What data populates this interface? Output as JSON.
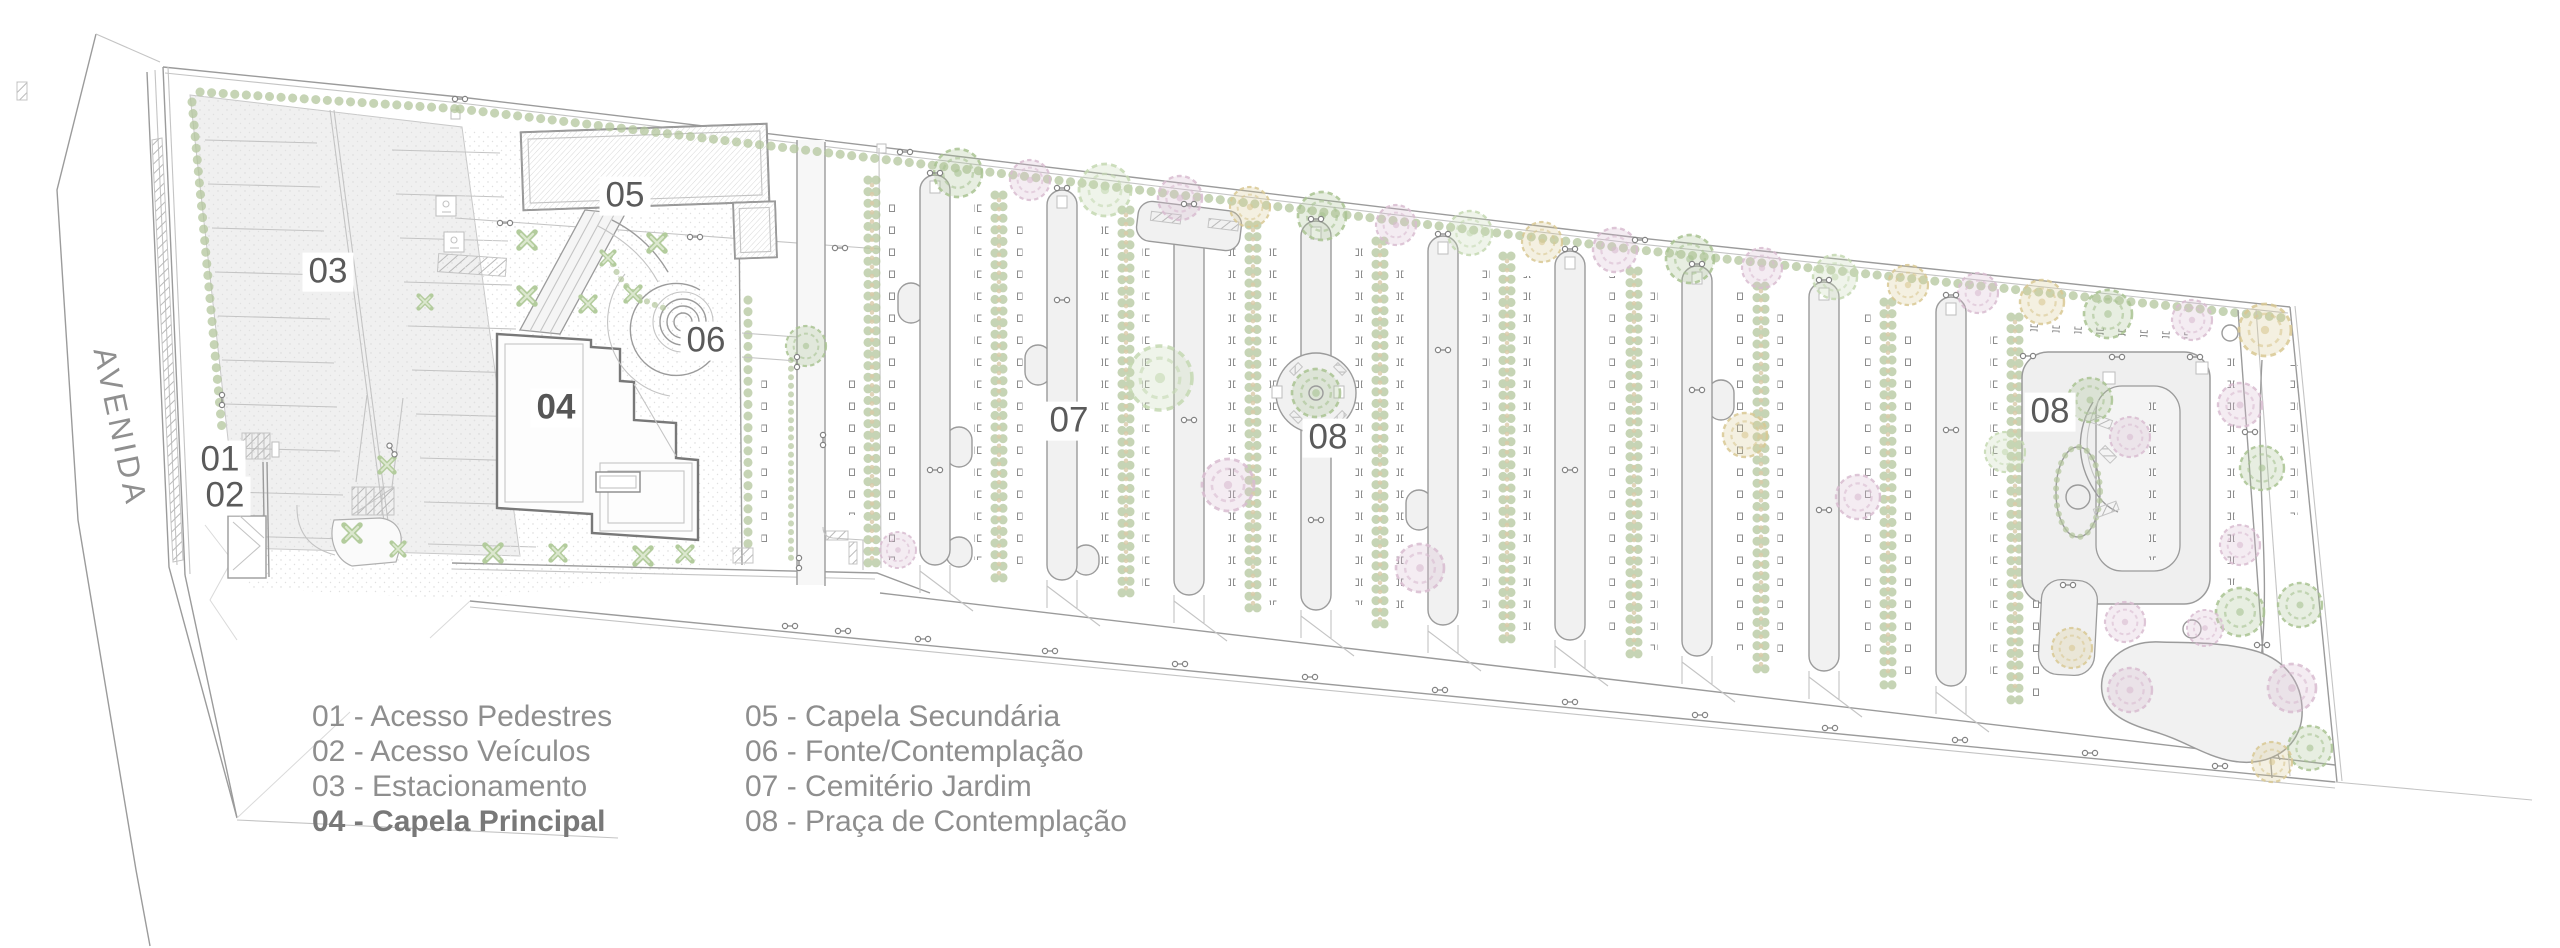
{
  "palette": {
    "line-mid": "#9b9b9b",
    "line-light": "#c4c4c4",
    "path-fill": "#f1f1f1",
    "hedge": "#b3c69c",
    "hedge-accent": "#d9c9a8",
    "tree-green": "#a9c392",
    "tree-pale": "#c4d8b2",
    "tree-pink": "#d8bcd0",
    "tree-yellow": "#d8c893",
    "ink": "#5a5a5a",
    "legend-ink": "#8e8e8e",
    "street-ink": "#8f8f8f"
  },
  "plan": {
    "street_label": "AVENIDA",
    "markers": [
      {
        "label": "01"
      },
      {
        "label": "02"
      },
      {
        "label": "03"
      },
      {
        "label": "04"
      },
      {
        "label": "05"
      },
      {
        "label": "06"
      },
      {
        "label": "07"
      },
      {
        "label": "08"
      },
      {
        "label": "08"
      }
    ]
  },
  "legend": {
    "columns": [
      {
        "items": [
          {
            "text": "01 - Acesso Pedestres",
            "bold": false
          },
          {
            "text": "02 - Acesso Veículos",
            "bold": false
          },
          {
            "text": "03 - Estacionamento",
            "bold": false
          },
          {
            "text": "04 - Capela Principal",
            "bold": true
          }
        ]
      },
      {
        "items": [
          {
            "text": "05 - Capela Secundária",
            "bold": false
          },
          {
            "text": "06 - Fonte/Contemplação",
            "bold": false
          },
          {
            "text": "07 - Cemitério Jardim",
            "bold": false
          },
          {
            "text": "08 - Praça de Contemplação",
            "bold": false
          }
        ]
      }
    ]
  }
}
